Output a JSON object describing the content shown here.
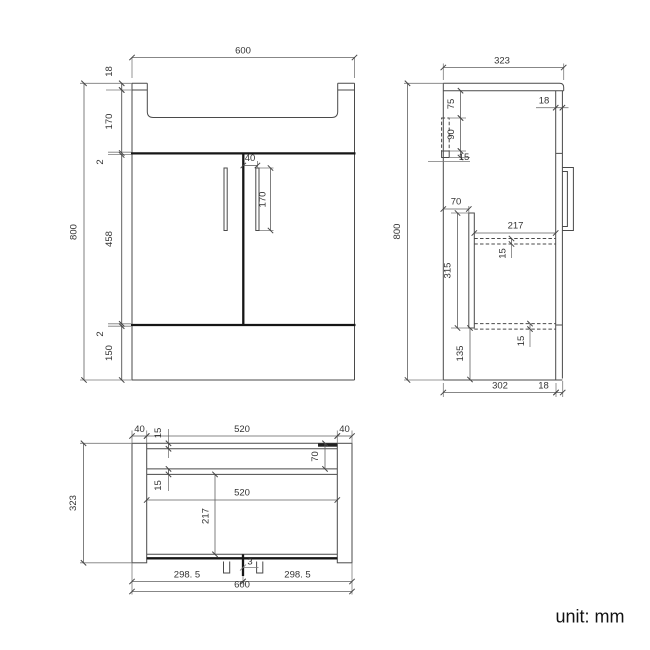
{
  "unit_label": "unit: mm",
  "colors": {
    "line": "#4a4a4a",
    "thick_line": "#161616",
    "dimension": "#5f5f5f",
    "text": "#333333",
    "filled_bar": "#222222",
    "background": "#ffffff"
  },
  "front": {
    "width": "600",
    "height": "800",
    "rim": "18",
    "basin": "170",
    "gap_top": "2",
    "door": "458",
    "gap_bottom": "2",
    "plinth": "150",
    "handle_offset": "40",
    "handle_length": "170"
  },
  "side": {
    "depth": "323",
    "height": "800",
    "door_thickness": "18",
    "bracket_top": "75",
    "bracket_height": "90",
    "bracket_foot": "15",
    "rail_offset": "70",
    "shelf_depth": "217",
    "shelf_thickness": "15",
    "panel_height": "315",
    "bottom_space": "135",
    "bottom_thickness": "15",
    "base_depth": "302",
    "front_lip": "18"
  },
  "plan": {
    "panel_left": "40",
    "back_width": "520",
    "panel_right": "40",
    "back_thickness": "15",
    "rail_depth": "70",
    "rail_thickness": "15",
    "inner_width": "520",
    "inner_depth": "217",
    "depth": "323",
    "door_gap": "3",
    "door_left": "298. 5",
    "door_right": "298. 5",
    "width": "600"
  }
}
